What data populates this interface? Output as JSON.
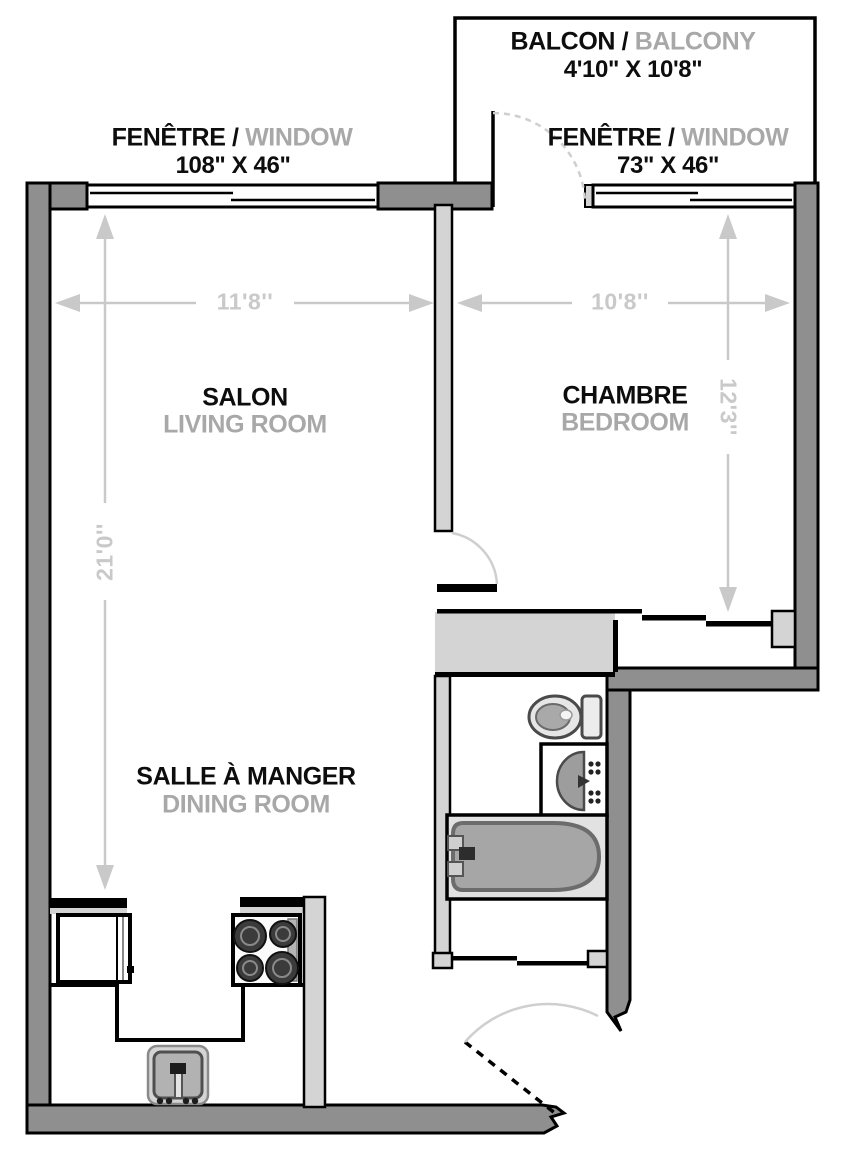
{
  "document": {
    "type": "apartment-floor-plan"
  },
  "separator": "/",
  "colors": {
    "exterior_wall": "#8f8f8f",
    "interior_wall_light": "#d4d4d4",
    "dimension_gray": "#c9c9c9",
    "door_arc_gray": "#cfcfcf",
    "label_primary_black": "#0d0d0d",
    "label_secondary_gray": "#a8a8a8",
    "fixture_gray": "#a6a6a6"
  },
  "balcony": {
    "name_fr": "BALCON",
    "name_en": "BALCONY",
    "size": "4'10\" X 10'8\""
  },
  "windows": {
    "left": {
      "name_fr": "FENÊTRE",
      "name_en": "WINDOW",
      "size": "108\" X 46\""
    },
    "right": {
      "name_fr": "FENÊTRE",
      "name_en": "WINDOW",
      "size": "73\" X 46\""
    }
  },
  "rooms": {
    "living": {
      "name_fr": "SALON",
      "name_en": "LIVING ROOM"
    },
    "bedroom": {
      "name_fr": "CHAMBRE",
      "name_en": "BEDROOM"
    },
    "dining": {
      "name_fr": "SALLE À MANGER",
      "name_en": "DINING ROOM"
    }
  },
  "dimensions": {
    "living_width": "11'8''",
    "bedroom_width": "10'8''",
    "living_length": "21'0''",
    "bedroom_length": "12'3''"
  },
  "fixtures": [
    "toilet",
    "vanity-sink",
    "bathtub",
    "refrigerator",
    "stove",
    "kitchen-sink"
  ]
}
